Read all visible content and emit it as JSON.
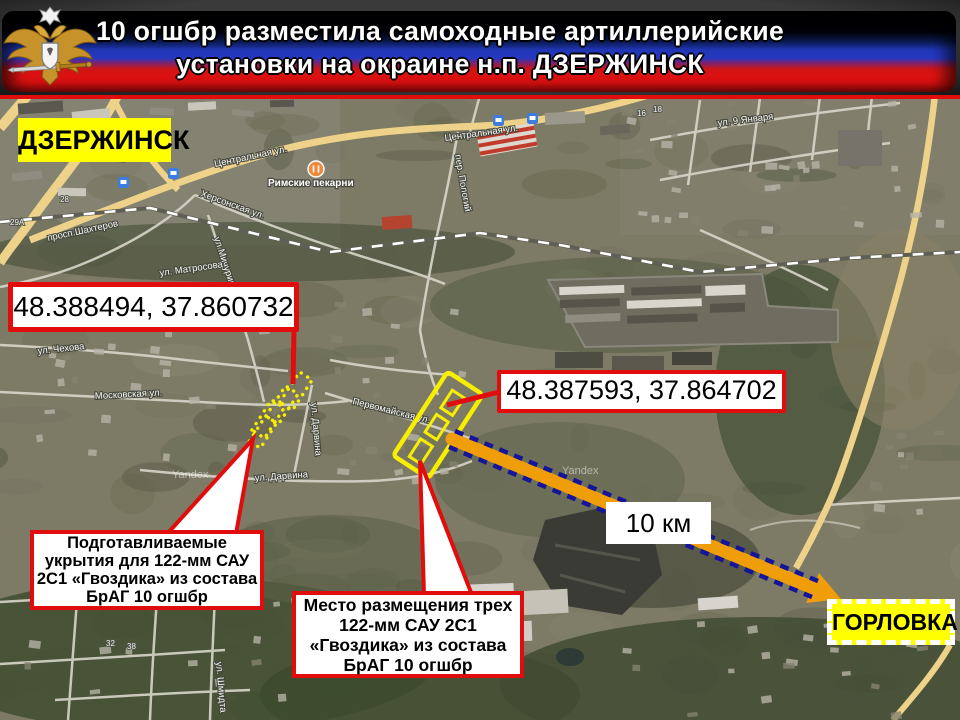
{
  "banner": {
    "title_line1": "10 огшбр разместила самоходные артиллерийские",
    "title_line2": "установки на окраине н.п. ДЗЕРЖИНСК",
    "emblem_name": "armed-forces-double-eagle",
    "flag_colors": {
      "black": "#020202",
      "blue": "#2036b4",
      "red": "#e01010"
    }
  },
  "map": {
    "city_label": "ДЗЕРЖИНСК",
    "destination_label": "ГОРЛОВКА",
    "distance_label": "10 км",
    "coordinate_boxes": [
      {
        "text": "48.388494, 37.860732"
      },
      {
        "text": "48.387593, 37.864702"
      }
    ],
    "callouts": [
      {
        "lines": [
          "Подготавливаемые",
          "укрытия для 122-мм САУ",
          "2С1 «Гвоздика» из состава",
          "БрАГ 10 огшбр"
        ]
      },
      {
        "lines": [
          "Место размещения трех",
          "122-мм САУ 2С1",
          "«Гвоздика» из состава",
          "БрАГ 10 огшбр"
        ]
      }
    ],
    "street_labels": [
      {
        "text": "Центральная ул."
      },
      {
        "text": "Центральная ул."
      },
      {
        "text": "просп.Шахтеров"
      },
      {
        "text": "Херсонская ул."
      },
      {
        "text": "ул.Мичурина"
      },
      {
        "text": "ул. Чехова"
      },
      {
        "text": "Московская ул."
      },
      {
        "text": "ул. Дарвина"
      },
      {
        "text": "ул. Дарвина"
      },
      {
        "text": "Первомайская ул."
      },
      {
        "text": "ул. 9 Января"
      },
      {
        "text": "пер. Пологий"
      },
      {
        "text": "ул. Шмидта"
      },
      {
        "text": "ул. Матросова"
      }
    ],
    "poi_labels": [
      {
        "text": "Римские пекарни"
      }
    ],
    "house_numbers": [
      "28",
      "29А",
      "16",
      "18",
      "32",
      "38"
    ],
    "watermark": "Yandex",
    "colors": {
      "accent_red": "#e10d0c",
      "marker_yellow": "#f7ee00",
      "label_yellow": "#ffff00",
      "arrow_orange": "#f09d0a",
      "arrow_dash_blue": "#15159a"
    }
  }
}
